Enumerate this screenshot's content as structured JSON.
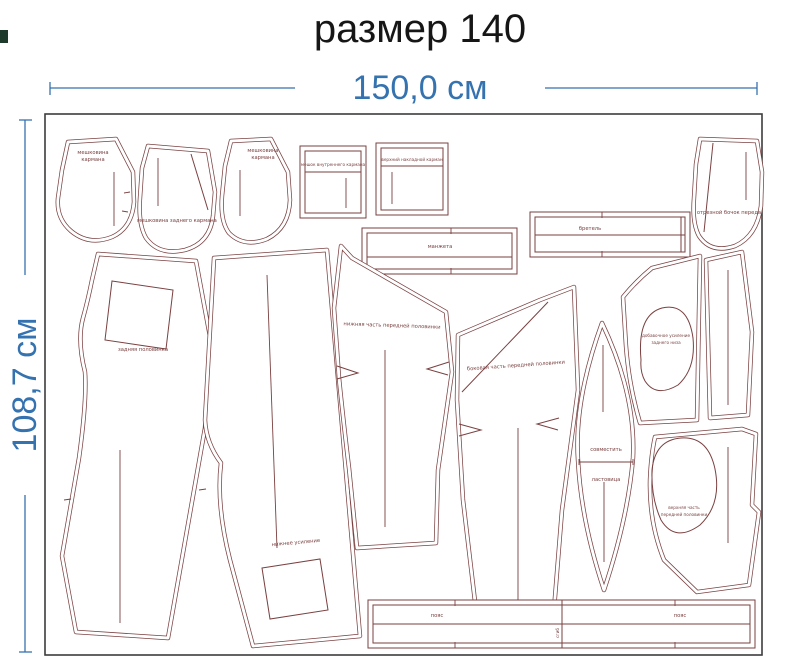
{
  "title": "размер 140",
  "dimensions": {
    "width_label": "150,0 см",
    "height_label": "108,7 см"
  },
  "colors": {
    "outline": "#7a4040",
    "dimension_blue": "#3572b0",
    "title_black": "#161616",
    "fabric_border": "#3c3c3c"
  },
  "pieces": [
    {
      "id": "pocket-bag-left",
      "labels": [
        "мешковина",
        "кармана"
      ]
    },
    {
      "id": "pocket-bag-center",
      "labels": [
        "мешковина заднего кармана"
      ]
    },
    {
      "id": "pocket-bag-right",
      "labels": [
        "мешковина",
        "кармана"
      ]
    },
    {
      "id": "inner-pocket",
      "labels": [
        "мешок внутреннего кармана"
      ]
    },
    {
      "id": "patch-pocket",
      "labels": [
        "верхний накладной карман"
      ]
    },
    {
      "id": "cuff",
      "labels": [
        "манжета"
      ]
    },
    {
      "id": "strap",
      "labels": [
        "бретель"
      ]
    },
    {
      "id": "front-side-panel",
      "labels": [
        "отрезной бочок переда"
      ]
    },
    {
      "id": "back-half",
      "labels": [
        "задняя половинка"
      ]
    },
    {
      "id": "front-half",
      "labels": [
        "нижнее усиление"
      ]
    },
    {
      "id": "lower-front-part",
      "labels": [
        "нижняя часть передней половинки"
      ]
    },
    {
      "id": "side-front-part",
      "labels": [
        "боковая часть передней половинки"
      ]
    },
    {
      "id": "gusset",
      "labels": [
        "совместить",
        "ластовица"
      ]
    },
    {
      "id": "extra-reinforcement",
      "labels": [
        "добавочное усиление",
        "заднего низа"
      ]
    },
    {
      "id": "right-strip",
      "labels": []
    },
    {
      "id": "upper-front-part",
      "labels": [
        "верхняя часть",
        "передней половинки"
      ]
    },
    {
      "id": "waistband",
      "labels": [
        "пояс",
        "сгиб",
        "пояс"
      ]
    }
  ]
}
